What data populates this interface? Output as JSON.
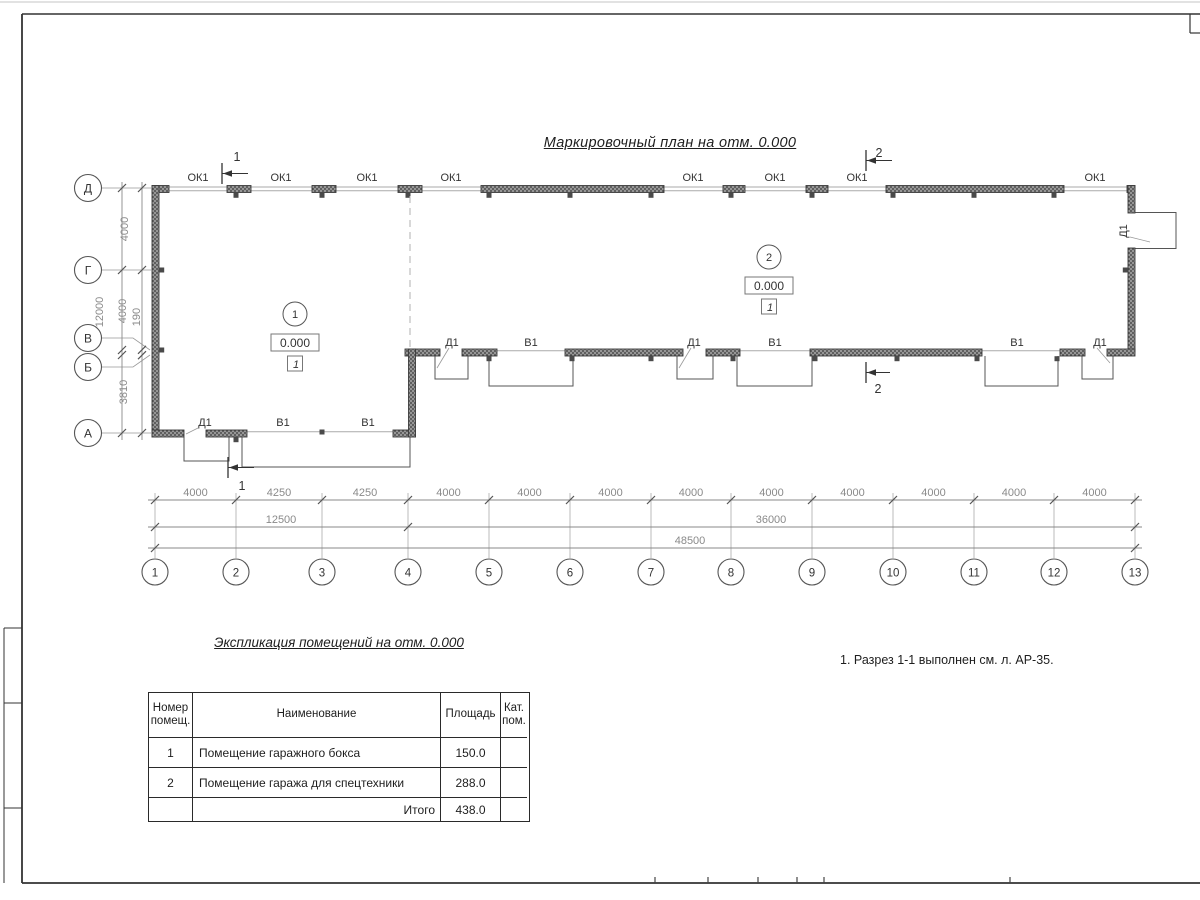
{
  "sheet": {
    "title": "Маркировочный план на отм. 0.000",
    "note": "1. Разрез 1-1 выполнен см. л. АР-35."
  },
  "labels": {
    "window": "ОК1",
    "door": "Д1",
    "gate": "В1"
  },
  "rooms": [
    {
      "number": "1",
      "elevation": "0.000",
      "floor_type": "1"
    },
    {
      "number": "2",
      "elevation": "0.000",
      "floor_type": "1"
    }
  ],
  "sections": [
    {
      "number": "1"
    },
    {
      "number": "2"
    }
  ],
  "grid": {
    "columns": [
      "1",
      "2",
      "3",
      "4",
      "5",
      "6",
      "7",
      "8",
      "9",
      "10",
      "11",
      "12",
      "13"
    ],
    "column_spacings": [
      "4000",
      "4250",
      "4250",
      "4000",
      "4000",
      "4000",
      "4000",
      "4000",
      "4000",
      "4000",
      "4000",
      "4000"
    ],
    "rows": [
      "Д",
      "Г",
      "В",
      "Б",
      "А"
    ],
    "row_spacings": [
      "4000",
      "4000",
      "190",
      "3810"
    ],
    "totals": {
      "left_overall": "12000",
      "bottom_sub1": "12500",
      "bottom_sub2": "36000",
      "bottom_overall": "48500"
    }
  },
  "table": {
    "title": "Экспликация помещений на отм. 0.000",
    "headers": [
      "Номер\nпомещ.",
      "Наименование",
      "Площадь",
      "Кат.\nпом."
    ],
    "rows": [
      [
        "1",
        "Помещение гаражного бокса",
        "150.0",
        ""
      ],
      [
        "2",
        "Помещение гаража для спецтехники",
        "288.0",
        ""
      ]
    ],
    "total_label": "Итого",
    "total_value": "438.0"
  }
}
